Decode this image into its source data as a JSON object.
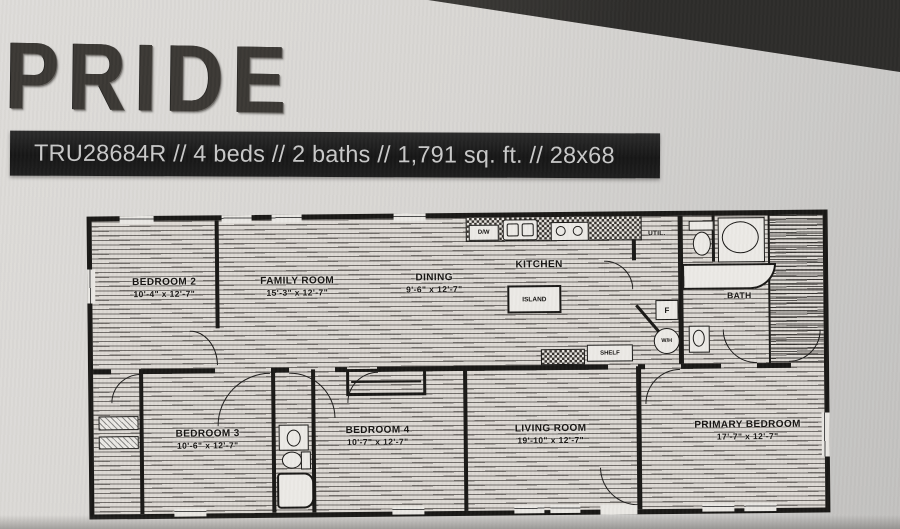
{
  "header": {
    "brand": "PRIDE",
    "spec_line": "TRU28684R // 4 beds // 2 baths // 1,791 sq. ft. // 28x68"
  },
  "floor_plan": {
    "rooms": {
      "bedroom2": {
        "name": "BEDROOM 2",
        "dims": "10'-4\" x 12'-7\""
      },
      "family_room": {
        "name": "FAMILY ROOM",
        "dims": "15'-3\" x 12'-7\""
      },
      "dining": {
        "name": "DINING",
        "dims": "9'-6\" x 12'-7\""
      },
      "kitchen": {
        "name": "KITCHEN"
      },
      "utility": {
        "name": "UTIL."
      },
      "bath": {
        "name": "BATH"
      },
      "bedroom3": {
        "name": "BEDROOM 3",
        "dims": "10'-6\" x 12'-7\""
      },
      "bedroom4": {
        "name": "BEDROOM 4",
        "dims": "10'-7\" x 12'-7\""
      },
      "living_room": {
        "name": "LIVING ROOM",
        "dims": "19'-10\" x 12'-7\""
      },
      "primary_bedroom": {
        "name": "PRIMARY BEDROOM",
        "dims": "17'-7\" x 12'-7\""
      }
    },
    "fixture_labels": {
      "island": "ISLAND",
      "dishwasher": "D/W",
      "shelf": "SHELF",
      "furnace": "F",
      "water_heater": "W/H"
    }
  },
  "colors": {
    "banner_bg": "#1b1b1b",
    "banner_text": "#c9c9c9",
    "plan_ink": "#181715",
    "photo_bg": "#d6d4d1",
    "corner_shadow": "#3b3a37"
  }
}
